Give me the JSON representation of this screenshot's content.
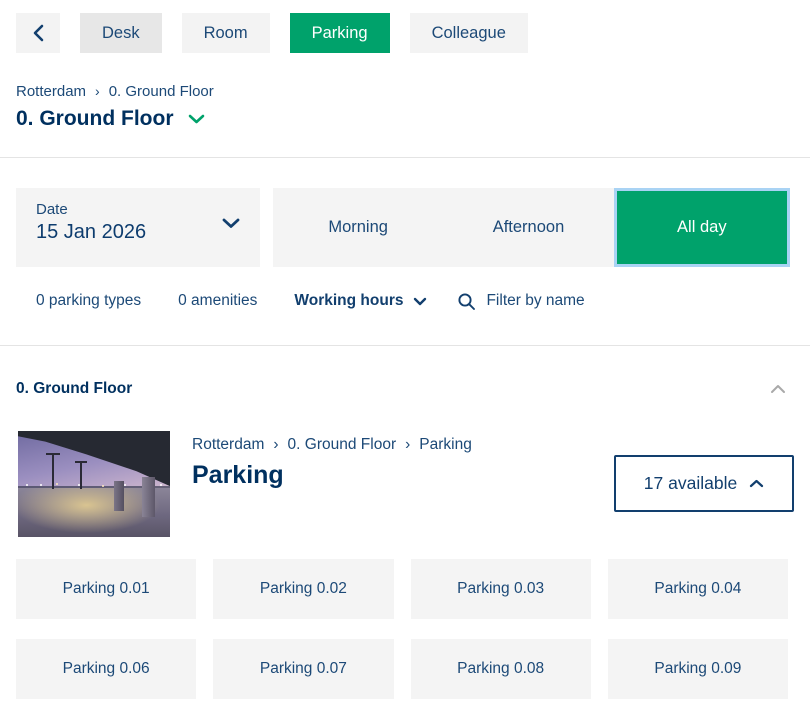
{
  "colors": {
    "accent_green": "#00a26b",
    "navy_text": "#1c4977",
    "navy_dark": "#00305f",
    "focus_ring_blue": "#a9d3f4",
    "button_gray": "#f3f3f3",
    "button_gray_dim": "#e7e7e7",
    "divider_gray": "#e4e4e4"
  },
  "top_nav": {
    "tabs": [
      {
        "label": "Desk",
        "active": false
      },
      {
        "label": "Room",
        "active": false
      },
      {
        "label": "Parking",
        "active": true
      },
      {
        "label": "Colleague",
        "active": false
      }
    ]
  },
  "breadcrumb": {
    "separator": "›",
    "items": [
      "Rotterdam",
      "0. Ground Floor"
    ]
  },
  "page_header": {
    "floor_title": "0. Ground Floor"
  },
  "filters": {
    "date": {
      "label": "Date",
      "value": "15 Jan 2026"
    },
    "day_parts": [
      {
        "label": "Morning",
        "selected": false
      },
      {
        "label": "Afternoon",
        "selected": false
      },
      {
        "label": "All day",
        "selected": true
      }
    ],
    "chips": [
      {
        "label": "0 parking types"
      },
      {
        "label": "0 amenities"
      },
      {
        "label": "Working hours"
      }
    ],
    "search_placeholder": "Filter by name"
  },
  "section": {
    "title": "0. Ground Floor"
  },
  "area_card": {
    "breadcrumb": [
      "Rotterdam",
      "0. Ground Floor",
      "Parking"
    ],
    "separator": "›",
    "title": "Parking",
    "availability": "17 available"
  },
  "parking_grid": {
    "spots": [
      "Parking 0.01",
      "Parking 0.02",
      "Parking 0.03",
      "Parking 0.04",
      "Parking 0.06",
      "Parking 0.07",
      "Parking 0.08",
      "Parking 0.09"
    ]
  }
}
